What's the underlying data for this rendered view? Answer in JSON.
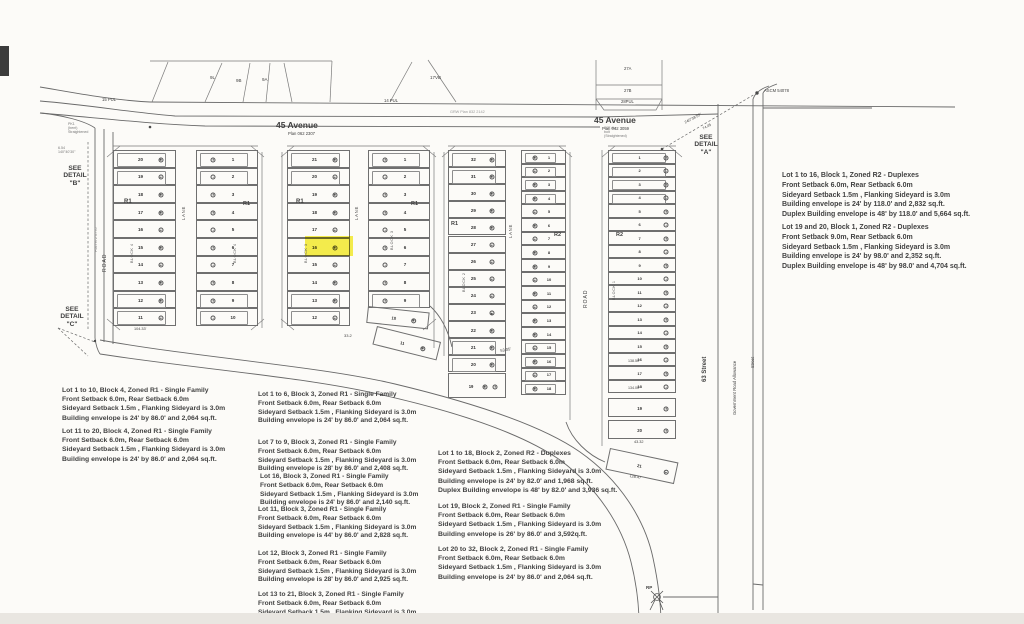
{
  "colors": {
    "paper": "#fcfbf8",
    "line_ink": "#6a6a6a",
    "text_ink": "#3f3f3f",
    "highlight": "#f5ec2f",
    "bottom_band": "#e9e6e1"
  },
  "plat": {
    "highlight": {
      "x": 305,
      "y": 236,
      "w": 48,
      "h": 20,
      "lot": "16",
      "block": "3"
    },
    "columns": [
      {
        "name": "block4-west",
        "x": 113,
        "y": 150,
        "w": 63,
        "rowH": 17.6,
        "sym": "right",
        "numX": 0.42,
        "symX": 0.74,
        "numFs": 4.5,
        "env": [
          0,
          1,
          8,
          9
        ],
        "lots": [
          "20",
          "19",
          "18",
          "17",
          "16",
          "15",
          "14",
          "13",
          "12",
          "11"
        ]
      },
      {
        "name": "block4-east",
        "x": 196,
        "y": 150,
        "w": 62,
        "rowH": 17.6,
        "sym": "left",
        "numX": 0.58,
        "symX": 0.26,
        "numFs": 4.5,
        "env": [
          0,
          1,
          8,
          9
        ],
        "lots": [
          "1",
          "2",
          "3",
          "4",
          "5",
          "6",
          "7",
          "8",
          "9",
          "10"
        ]
      },
      {
        "name": "block3-west",
        "x": 287,
        "y": 150,
        "w": 63,
        "rowH": 17.6,
        "sym": "right",
        "numX": 0.42,
        "symX": 0.74,
        "numFs": 4.5,
        "env": [
          0,
          1,
          8,
          9
        ],
        "lots": [
          "21",
          "20",
          "19",
          "18",
          "17",
          "16",
          "15",
          "14",
          "13",
          "12"
        ]
      },
      {
        "name": "block3-east",
        "x": 368,
        "y": 150,
        "w": 62,
        "rowH": 17.6,
        "sym": "left",
        "numX": 0.58,
        "symX": 0.26,
        "numFs": 4.5,
        "env": [
          0,
          1,
          8
        ],
        "lots": [
          "1",
          "2",
          "3",
          "4",
          "5",
          "6",
          "7",
          "8",
          "9"
        ]
      },
      {
        "name": "block2-west",
        "x": 448,
        "y": 150,
        "w": 58,
        "rowH": 17.1,
        "sym": "right",
        "numX": 0.42,
        "symX": 0.74,
        "numFs": 4.5,
        "env": [
          0,
          1,
          11,
          12
        ],
        "lots": [
          "32",
          "31",
          "30",
          "29",
          "28",
          "27",
          "26",
          "25",
          "24",
          "23",
          "22",
          "21",
          "20"
        ]
      },
      {
        "name": "block2-east",
        "x": 521,
        "y": 150,
        "w": 45,
        "rowH": 13.6,
        "sym": "left",
        "numX": 0.6,
        "symX": 0.28,
        "numFs": 4,
        "env": [
          0,
          1,
          2,
          3,
          14,
          15,
          16,
          17
        ],
        "lots": [
          "1",
          "2",
          "3",
          "4",
          "5",
          "6",
          "7",
          "8",
          "9",
          "10",
          "11",
          "12",
          "13",
          "14",
          "15",
          "16",
          "17",
          "18"
        ]
      },
      {
        "name": "block1",
        "x": 608,
        "y": 150,
        "w": 68,
        "rowH": 13.5,
        "sym": "right",
        "numX": 0.45,
        "symX": 0.84,
        "numFs": 4,
        "env": [
          0,
          1,
          2,
          3
        ],
        "lots": [
          "1",
          "2",
          "3",
          "4",
          "5",
          "6",
          "7",
          "8",
          "9",
          "10",
          "11",
          "12",
          "13",
          "14",
          "15",
          "16",
          "17",
          "18"
        ]
      }
    ],
    "angled_lots": [
      {
        "name": "block3-lot10",
        "label": "10",
        "x": 368,
        "y": 306,
        "w": 62,
        "h": 17,
        "rot": 6,
        "numX": 0.42,
        "symX": 0.74
      },
      {
        "name": "block3-lot11",
        "label": "11",
        "x": 377,
        "y": 326,
        "w": 66,
        "h": 19,
        "rot": 14,
        "numX": 0.42,
        "symX": 0.74
      },
      {
        "name": "block2-lot19",
        "label": "19",
        "x": 448,
        "y": 373,
        "w": 58,
        "h": 25,
        "rot": 0,
        "numX": 0.38,
        "symX": 0.62,
        "symX2": 0.8
      },
      {
        "name": "block1-lot19",
        "label": "19",
        "x": 608,
        "y": 398,
        "w": 68,
        "h": 19,
        "rot": 0,
        "numX": 0.45,
        "symX": 0.84
      },
      {
        "name": "block1-lot20",
        "label": "20",
        "x": 608,
        "y": 420,
        "w": 68,
        "h": 19,
        "rot": 0,
        "numX": 0.45,
        "symX": 0.84
      },
      {
        "name": "block1-lot21",
        "label": "21",
        "x": 610,
        "y": 448,
        "w": 70,
        "h": 22,
        "rot": 12,
        "numX": 0.45,
        "symX": 0.84
      }
    ]
  },
  "annotations": [
    {
      "name": "avenue-label-west",
      "text": "45 Avenue",
      "x": 276,
      "y": 121,
      "fs": 8.5,
      "bold": true
    },
    {
      "name": "avenue-plan-west",
      "text": "Plan 062 2307",
      "x": 288,
      "y": 132,
      "fs": 4.2
    },
    {
      "name": "avenue-label-east",
      "text": "45 Avenue",
      "x": 594,
      "y": 116,
      "fs": 8.5,
      "bold": true
    },
    {
      "name": "avenue-plan-east",
      "text": "Plan 042 3059",
      "x": 602,
      "y": 127,
      "fs": 4.2
    },
    {
      "name": "see-detail-b",
      "text": "SEE\nDETAIL\n\"B\"",
      "x": 45,
      "y": 165,
      "fs": 6.6,
      "bold": true,
      "w": 60
    },
    {
      "name": "see-detail-c",
      "text": "SEE\nDETAIL\n\"C\"",
      "x": 42,
      "y": 306,
      "fs": 6.6,
      "bold": true,
      "w": 60
    },
    {
      "name": "see-detail-a",
      "text": "SEE\nDETAIL\n\"A\"",
      "x": 676,
      "y": 134,
      "fs": 6.6,
      "bold": true,
      "w": 60
    },
    {
      "name": "ascm-label",
      "text": "ASCM 54078",
      "x": 764,
      "y": 89,
      "fs": 4.2
    },
    {
      "name": "rp-label",
      "text": "RP",
      "x": 646,
      "y": 585,
      "fs": 4.5,
      "bold": true
    },
    {
      "name": "street-63-label",
      "text": "63 Street",
      "x": 702,
      "y": 382,
      "fs": 6,
      "bold": true,
      "rot": -90
    },
    {
      "name": "gov-road-allowance-label",
      "text": "Government  Road  Allowance",
      "x": 733,
      "y": 415,
      "fs": 4.2,
      "rot": -90
    },
    {
      "name": "street-right-label",
      "text": "Street",
      "x": 751,
      "y": 368,
      "fs": 4.2,
      "rot": -90
    },
    {
      "name": "road-west-label",
      "text": "ROAD",
      "x": 103,
      "y": 272,
      "fs": 5,
      "rot": -90,
      "ls": 1
    },
    {
      "name": "plan-west-road",
      "text": "Plan 972 0776",
      "x": 94,
      "y": 252,
      "fs": 3.8,
      "rot": -90,
      "color": "#8a8a8a"
    },
    {
      "name": "road-east-label",
      "text": "ROAD",
      "x": 584,
      "y": 308,
      "fs": 5,
      "rot": -90,
      "ls": 1
    },
    {
      "name": "lane-label-1",
      "text": "LANE",
      "x": 182,
      "y": 220,
      "fs": 4.2,
      "rot": -90,
      "ls": 0.8
    },
    {
      "name": "lane-label-2",
      "text": "LANE",
      "x": 355,
      "y": 220,
      "fs": 4.2,
      "rot": -90,
      "ls": 0.8
    },
    {
      "name": "lane-label-3",
      "text": "LANE",
      "x": 509,
      "y": 238,
      "fs": 4.2,
      "rot": -90,
      "ls": 0.8
    },
    {
      "name": "zone-r1-block4-west",
      "text": "R1",
      "x": 124,
      "y": 199,
      "fs": 6,
      "bold": true
    },
    {
      "name": "zone-r1-block4-east",
      "text": "R1",
      "x": 243,
      "y": 201,
      "fs": 5.5,
      "bold": true
    },
    {
      "name": "zone-r1-block3-west",
      "text": "R1",
      "x": 296,
      "y": 199,
      "fs": 6,
      "bold": true
    },
    {
      "name": "zone-r1-block3-east",
      "text": "R1",
      "x": 411,
      "y": 201,
      "fs": 5.5,
      "bold": true
    },
    {
      "name": "zone-r1-block2-west",
      "text": "R1",
      "x": 451,
      "y": 221,
      "fs": 5.5,
      "bold": true
    },
    {
      "name": "zone-r2-block2-east",
      "text": "R2",
      "x": 554,
      "y": 232,
      "fs": 5.5,
      "bold": true
    },
    {
      "name": "zone-r2-block1",
      "text": "R2",
      "x": 616,
      "y": 232,
      "fs": 5.5,
      "bold": true
    },
    {
      "name": "block4-label-west",
      "text": "BLOCK 4",
      "x": 130,
      "y": 263,
      "fs": 3.8,
      "rot": -90,
      "ls": 0.5,
      "color": "#555555"
    },
    {
      "name": "block4-label-east",
      "text": "BLOCK 4",
      "x": 233,
      "y": 263,
      "fs": 3.8,
      "rot": -90,
      "ls": 0.5,
      "color": "#555555"
    },
    {
      "name": "block3-label-west",
      "text": "BLOCK 3",
      "x": 304,
      "y": 263,
      "fs": 3.8,
      "rot": -90,
      "ls": 0.5,
      "color": "#555555"
    },
    {
      "name": "block3-label-east",
      "text": "BLOCK 3",
      "x": 390,
      "y": 250,
      "fs": 3.8,
      "rot": -90,
      "ls": 0.5,
      "color": "#555555"
    },
    {
      "name": "block2-label-west",
      "text": "BLOCK 2",
      "x": 462,
      "y": 292,
      "fs": 3.8,
      "rot": -90,
      "ls": 0.5,
      "color": "#555555"
    },
    {
      "name": "block1-label",
      "text": "BLOCK 1",
      "x": 612,
      "y": 300,
      "fs": 3.8,
      "rot": -90,
      "ls": 0.5,
      "color": "#555555"
    },
    {
      "name": "parcel-9l",
      "text": "9L",
      "x": 210,
      "y": 75,
      "fs": 4.5
    },
    {
      "name": "parcel-9b",
      "text": "9B",
      "x": 236,
      "y": 78,
      "fs": 4.5
    },
    {
      "name": "parcel-9a",
      "text": "9A",
      "x": 262,
      "y": 77,
      "fs": 4.5
    },
    {
      "name": "parcel-17vb",
      "text": "17VB",
      "x": 430,
      "y": 75,
      "fs": 4.5
    },
    {
      "name": "parcel-27a",
      "text": "27A",
      "x": 624,
      "y": 67,
      "fs": 4.2
    },
    {
      "name": "parcel-27b",
      "text": "27B",
      "x": 624,
      "y": 89,
      "fs": 4.2
    },
    {
      "name": "parcel-28pul",
      "text": "28PUL",
      "x": 621,
      "y": 100,
      "fs": 4.2
    },
    {
      "name": "pul-west",
      "text": "15 PUL",
      "x": 102,
      "y": 98,
      "fs": 4.2
    },
    {
      "name": "pul-mid",
      "text": "14 PUL",
      "x": 384,
      "y": 99,
      "fs": 4.2
    },
    {
      "name": "bearing-detail-a",
      "text": "240°38'55\"",
      "x": 684,
      "y": 121,
      "fs": 3.8,
      "rot": -28
    },
    {
      "name": "bearing-distance",
      "text": "74.05",
      "x": 702,
      "y": 127,
      "fs": 3.6,
      "rot": -28
    },
    {
      "name": "note-pk-marker",
      "text": "PK1\n(bent)\nStraightened",
      "x": 68,
      "y": 122,
      "fs": 3.6,
      "color": "#777777"
    },
    {
      "name": "note-bolt-marker",
      "text": "1/2\" dia.\nbolt\n(Straightened)",
      "x": 604,
      "y": 126,
      "fs": 3.6,
      "color": "#777777"
    },
    {
      "name": "note-654",
      "text": "6.54\n140°40'30\"",
      "x": 58,
      "y": 146,
      "fs": 3.6,
      "color": "#777777"
    },
    {
      "name": "plan-grw",
      "text": "GRW Plan 832 2142",
      "x": 450,
      "y": 110,
      "fs": 3.8,
      "color": "#999999"
    },
    {
      "name": "dim-104-33",
      "text": "104.33'",
      "x": 134,
      "y": 327,
      "fs": 3.8
    },
    {
      "name": "dim-33-2",
      "text": "33.2",
      "x": 344,
      "y": 334,
      "fs": 4
    },
    {
      "name": "dim-53-05",
      "text": "53.05'",
      "x": 500,
      "y": 349,
      "fs": 4,
      "rot": -10
    },
    {
      "name": "dim-138-50",
      "text": "138.50'",
      "x": 628,
      "y": 359,
      "fs": 3.6
    },
    {
      "name": "dim-134-00",
      "text": "134.00'",
      "x": 628,
      "y": 386,
      "fs": 3.6
    },
    {
      "name": "dim-43-32",
      "text": "43.32",
      "x": 634,
      "y": 440,
      "fs": 3.8
    },
    {
      "name": "dim-128-47",
      "text": "128.47",
      "x": 630,
      "y": 474,
      "fs": 3.8,
      "rot": 10
    }
  ],
  "notes": [
    {
      "name": "note-block4-lots-1-10",
      "x": 62,
      "y": 386,
      "fs": 6.8,
      "lh": 9.2,
      "lines": [
        "Lot 1 to 10, Block 4, Zoned R1 - Single Family",
        "Front Setback 6.0m, Rear Setback 6.0m",
        "Sideyard Setback 1.5m , Flanking Sideyard is 3.0m",
        "Building envelope is 24' by 86.0'  and 2,064 sq.ft."
      ]
    },
    {
      "name": "note-block4-lots-11-20",
      "x": 62,
      "y": 427,
      "fs": 6.8,
      "lh": 9.2,
      "lines": [
        "Lot 11 to 20, Block 4, Zoned R1 - Single Family",
        "Front Setback 6.0m, Rear Setback 6.0m",
        "Sideyard Setback 1.5m , Flanking Sideyard is 3.0m",
        "Building envelope is 24' by 86.0'  and 2,064 sq.ft."
      ]
    },
    {
      "name": "note-block3-lots-1-6",
      "x": 258,
      "y": 391,
      "fs": 6.6,
      "lh": 8.8,
      "lines": [
        "Lot 1 to 6, Block 3, Zoned R1 - Single Family",
        "Front Setback 6.0m, Rear Setback 6.0m",
        "Sideyard Setback 1.5m , Flanking Sideyard is 3.0m",
        "Building envelope is 24' by 86.0'  and 2,064 sq.ft."
      ]
    },
    {
      "name": "note-block3-lots-7-9",
      "x": 258,
      "y": 439,
      "fs": 6.6,
      "lh": 8.8,
      "lines": [
        "Lot 7 to 9, Block 3, Zoned R1 - Single Family",
        "Front Setback 6.0m, Rear Setback 6.0m",
        "Sideyard Setback 1.5m , Flanking Sideyard is 3.0m",
        "Building envelope is 28' by 86.0'  and 2,408 sq.ft."
      ]
    },
    {
      "name": "note-block3-lot-16",
      "x": 260,
      "y": 473,
      "fs": 6.6,
      "lh": 8.8,
      "lines": [
        "Lot 16, Block 3, Zoned R1 - Single Family",
        "Front Setback 6.0m, Rear Setback 6.0m",
        "Sideyard Setback 1.5m , Flanking Sideyard is 3.0m",
        "Building envelope is 24' by 86.0'  and 2,140 sq.ft."
      ]
    },
    {
      "name": "note-block3-lot-11",
      "x": 258,
      "y": 506,
      "fs": 6.6,
      "lh": 8.8,
      "lines": [
        "Lot 11, Block 3, Zoned R1 - Single Family",
        "Front Setback 6.0m, Rear Setback 6.0m",
        "Sideyard Setback 1.5m , Flanking Sideyard is 3.0m",
        "Building envelope is 44' by 86.0'  and 2,828 sq.ft."
      ]
    },
    {
      "name": "note-block3-lot-12",
      "x": 258,
      "y": 550,
      "fs": 6.6,
      "lh": 8.8,
      "lines": [
        "Lot 12, Block 3, Zoned R1 - Single Family",
        "Front Setback 6.0m, Rear Setback 6.0m",
        "Sideyard Setback 1.5m , Flanking Sideyard is 3.0m",
        "Building envelope is 28' by 86.0'  and 2,925 sq.ft."
      ]
    },
    {
      "name": "note-block3-lots-13-21",
      "x": 258,
      "y": 591,
      "fs": 6.6,
      "lh": 8.8,
      "lines": [
        "Lot 13 to 21, Block 3, Zoned R1 - Single Family",
        "Front Setback 6.0m, Rear Setback 6.0m",
        "Sideyard Setback 1.5m . Flanking Sideyard is 3.0m"
      ]
    },
    {
      "name": "note-block2-lots-1-18",
      "x": 438,
      "y": 449,
      "fs": 6.8,
      "lh": 9.2,
      "lines": [
        "Lot 1 to 18, Block 2, Zoned R2 - Duplexes",
        "Front Setback 6.0m, Rear Setback 6.0m",
        "Sideyard Setback 1.5m , Flanking Sideyard is 3.0m",
        "Building envelope is 24' by 82.0'  and 1,968 sq.ft.",
        "Duplex Building envelope is 48' by 82.0'  and 3,936 sq.ft."
      ]
    },
    {
      "name": "note-block2-lot-19",
      "x": 438,
      "y": 502,
      "fs": 6.8,
      "lh": 9.2,
      "lines": [
        "Lot 19, Block 2, Zoned R1 - Single Family",
        "Front Setback 6.0m, Rear Setback 6.0m",
        "Sideyard Setback 1.5m , Flanking Sideyard is 3.0m",
        "Building envelope is 26' by 86.0'  and 3,592q.ft."
      ]
    },
    {
      "name": "note-block2-lots-20-32",
      "x": 438,
      "y": 545,
      "fs": 6.8,
      "lh": 9.2,
      "lines": [
        "Lot 20 to 32, Block 2, Zoned R1 - Single Family",
        "Front Setback 6.0m, Rear Setback 6.0m",
        "Sideyard Setback 1.5m , Flanking Sideyard is 3.0m",
        "Building envelope is 24' by 86.0'  and 2,064 sq.ft."
      ]
    },
    {
      "name": "note-block1-lots-1-16",
      "x": 782,
      "y": 171,
      "fs": 7,
      "lh": 9.8,
      "lines": [
        "Lot 1 to 16, Block 1, Zoned R2 - Duplexes",
        "Front Setback 6.0m, Rear Setback 6.0m",
        "Sideyard Setback 1.5m , Flanking Sideyard is 3.0m",
        "Building envelope is 24' by 118.0'  and 2,832 sq.ft.",
        "Duplex Building envelope is 48' by 118.0'  and 5,664 sq.ft."
      ]
    },
    {
      "name": "note-block1-lots-19-20",
      "x": 782,
      "y": 223,
      "fs": 7,
      "lh": 9.8,
      "lines": [
        "Lot 19 and 20, Block 1, Zoned R2 - Duplexes",
        "Front Setback 9.0m, Rear Setback 6.0m",
        "Sideyard Setback 1.5m , Flanking Sideyard is 3.0m",
        "Building envelope is 24' by 98.0'  and 2,352 sq.ft.",
        "Duplex Building envelope is 48' by 98.0'  and 4,704 sq.ft."
      ]
    }
  ]
}
